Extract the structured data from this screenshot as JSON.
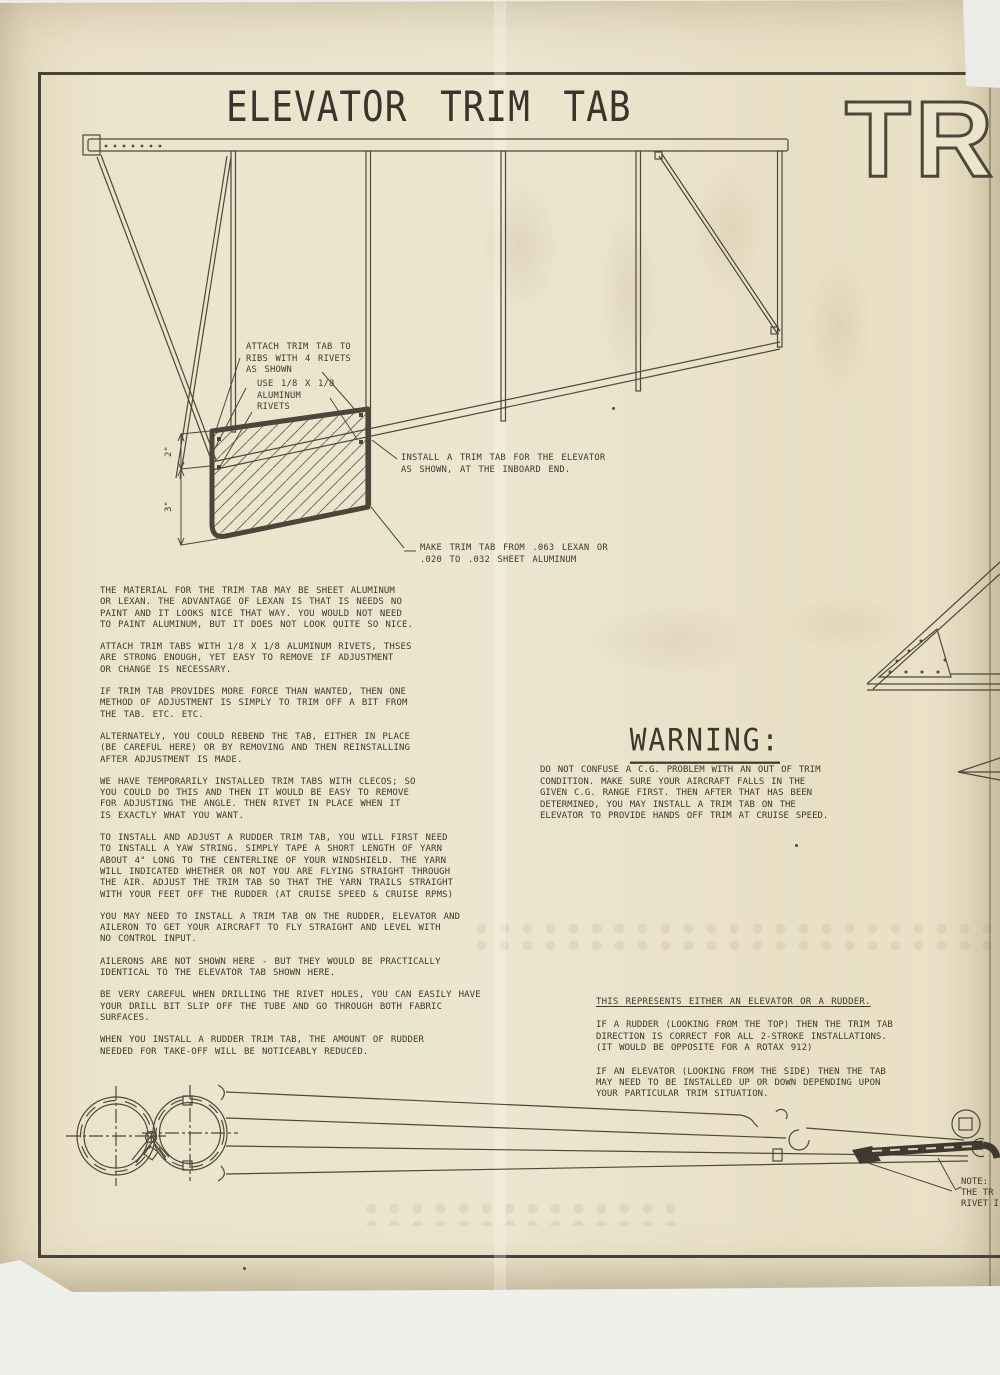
{
  "document": {
    "title": "ELEVATOR TRIM TAB",
    "corner_banner": "TRIM"
  },
  "diagram_annotations": {
    "attach_note": "ATTACH TRIM TAB TO\nRIBS WITH 4 RIVETS\nAS SHOWN",
    "rivet_note": "USE 1/8 X 1/8\nALUMINUM\nRIVETS",
    "install_note": "INSTALL A TRIM TAB FOR THE ELEVATOR\nAS SHOWN, AT THE INBOARD END.",
    "material_note": "MAKE TRIM TAB FROM .063 LEXAN OR\n.020 TO .032 SHEET ALUMINUM",
    "dimension_upper": "2\"",
    "dimension_lower": "3\""
  },
  "body_paragraphs": [
    "THE MATERIAL FOR THE TRIM TAB MAY BE SHEET ALUMINUM\nOR LEXAN.  THE ADVANTAGE OF LEXAN IS THAT IS NEEDS NO\nPAINT AND IT LOOKS NICE THAT WAY.  YOU WOULD NOT NEED\nTO  PAINT ALUMINUM, BUT IT DOES NOT LOOK QUITE SO NICE.",
    "ATTACH TRIM TABS WITH 1/8 X 1/8 ALUMINUM RIVETS, THSES\nARE STRONG ENOUGH, YET EASY TO REMOVE IF ADJUSTMENT\nOR CHANGE IS NECESSARY.",
    "IF TRIM TAB PROVIDES MORE FORCE THAN WANTED, THEN ONE\nMETHOD OF ADJUSTMENT IS SIMPLY TO TRIM OFF A BIT FROM\nTHE TAB.  ETC. ETC.",
    "ALTERNATELY, YOU COULD REBEND THE TAB, EITHER IN PLACE\n(BE CAREFUL HERE) OR BY REMOVING AND THEN REINSTALLING\nAFTER ADJUSTMENT IS MADE.",
    "WE HAVE TEMPORARILY INSTALLED TRIM TABS WITH CLECOS; SO\nYOU COULD DO THIS AND THEN IT WOULD BE EASY TO REMOVE\nFOR ADJUSTING THE ANGLE.  THEN RIVET IN PLACE WHEN IT\nIS EXACTLY WHAT YOU WANT.",
    "TO INSTALL AND ADJUST A RUDDER TRIM TAB, YOU WILL FIRST NEED\nTO INSTALL A YAW STRING.  SIMPLY TAPE A SHORT LENGTH OF YARN\nABOUT 4\" LONG TO THE CENTERLINE OF YOUR WINDSHIELD.  THE YARN\nWILL INDICATED WHETHER OR NOT YOU ARE FLYING STRAIGHT THROUGH\nTHE AIR.  ADJUST THE TRIM TAB  SO THAT THE YARN TRAILS STRAIGHT\nWITH YOUR FEET OFF THE RUDDER (AT CRUISE SPEED & CRUISE RPMS)",
    "YOU MAY NEED TO INSTALL A TRIM TAB ON THE RUDDER, ELEVATOR AND\nAILERON TO GET YOUR AIRCRAFT TO FLY STRAIGHT AND LEVEL WITH\nNO CONTROL INPUT.",
    "AILERONS ARE NOT SHOWN HERE - BUT THEY WOULD BE PRACTICALLY\nIDENTICAL TO THE ELEVATOR TAB SHOWN HERE.",
    "BE VERY CAREFUL WHEN DRILLING THE RIVET HOLES, YOU CAN EASILY HAVE\nYOUR DRILL BIT SLIP OFF THE TUBE AND GO THROUGH BOTH FABRIC\nSURFACES.",
    "WHEN YOU INSTALL A RUDDER TRIM TAB, THE AMOUNT OF RUDDER\nNEEDED FOR TAKE-OFF WILL BE NOTICEABLY REDUCED."
  ],
  "warning": {
    "heading": "WARNING:",
    "body": "DO NOT CONFUSE A C.G. PROBLEM WITH AN OUT OF TRIM\nCONDITION.  MAKE SURE YOUR AIRCRAFT FALLS IN THE\nGIVEN C.G. RANGE FIRST.  THEN AFTER THAT HAS BEEN\nDETERMINED, YOU MAY INSTALL A TRIM TAB ON THE\nELEVATOR TO PROVIDE HANDS OFF TRIM AT CRUISE SPEED."
  },
  "representation_note": {
    "heading": "THIS REPRESENTS EITHER AN ELEVATOR OR A RUDDER.",
    "rudder_para": "IF A RUDDER (LOOKING FROM THE TOP) THEN THE TRIM TAB\nDIRECTION IS CORRECT FOR ALL 2-STROKE INSTALLATIONS.\n(IT WOULD BE OPPOSITE FOR A ROTAX 912)",
    "elevator_para": "IF AN ELEVATOR (LOOKING FROM THE SIDE) THEN THE TAB\nMAY NEED TO BE INSTALLED UP OR DOWN DEPENDING UPON\nYOUR PARTICULAR TRIM SITUATION."
  },
  "edge_note": {
    "line1": "NOTE:",
    "line2": "THE TR",
    "line3": "RIVET I"
  },
  "colors": {
    "paper": "#ece3cb",
    "ink": "#3e3931",
    "line": "#4e483d",
    "heavy_line": "#47423a",
    "scanner_bg": "#ebece8"
  }
}
